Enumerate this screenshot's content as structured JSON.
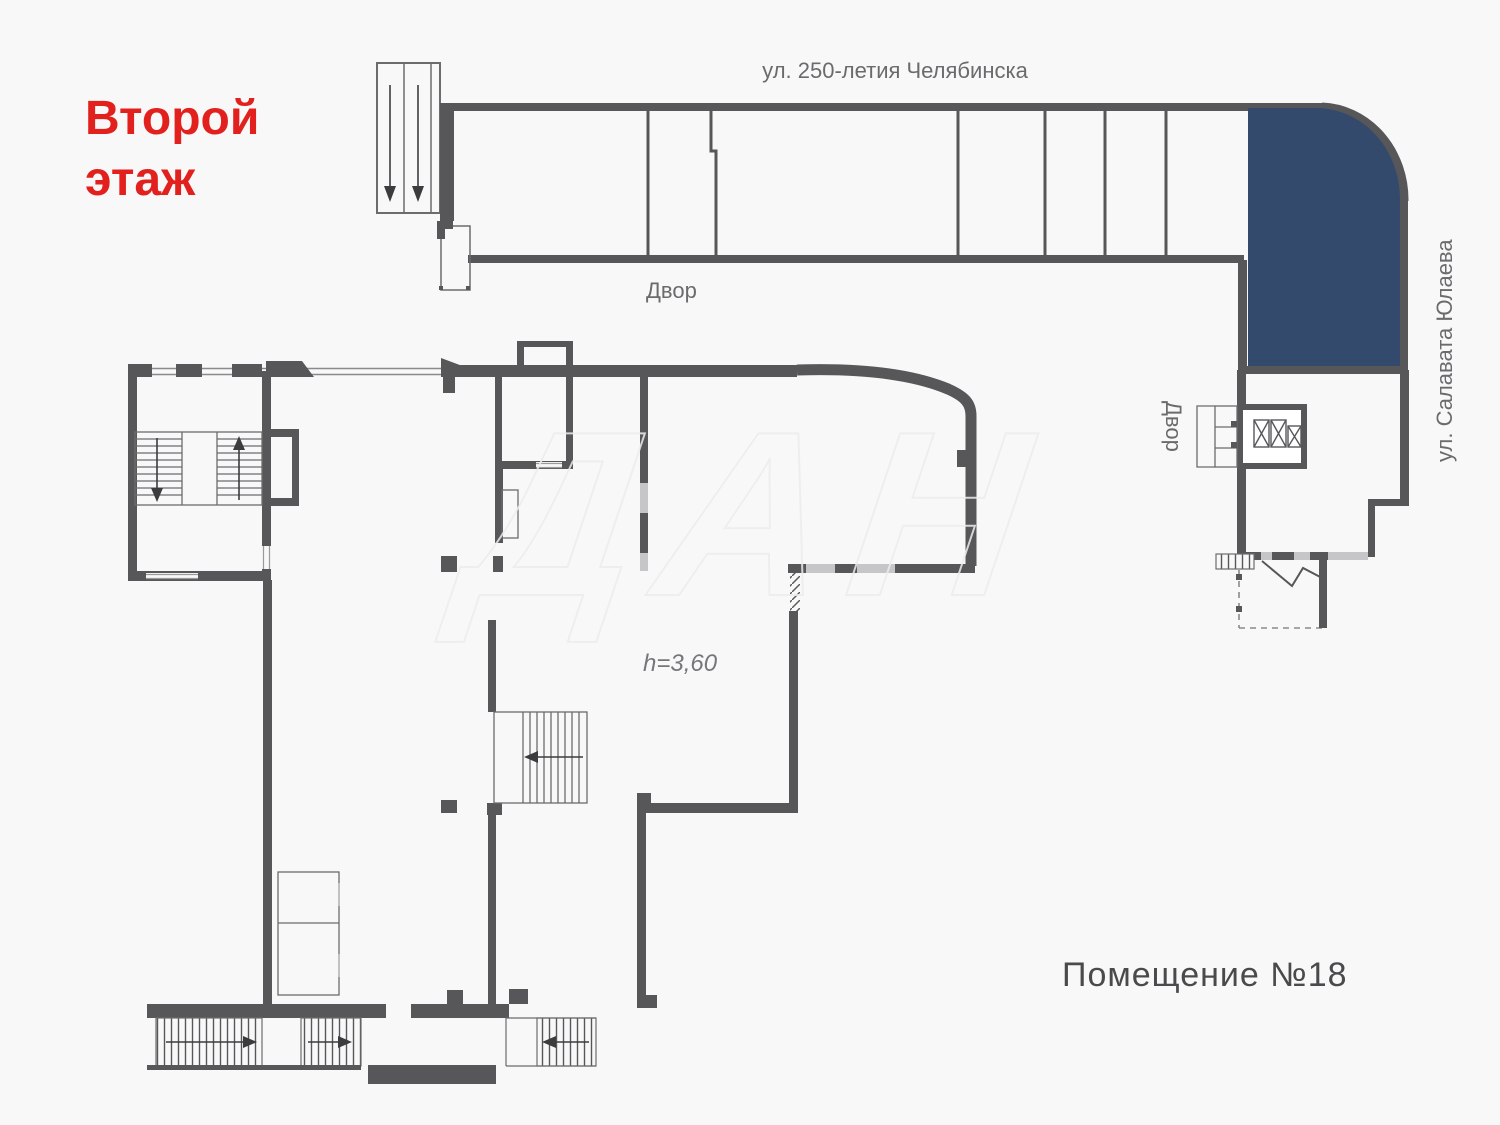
{
  "plan": {
    "floor_title": "Второй\nэтаж",
    "premises_label": "Помещение №18",
    "ceiling_height": "h=3,60"
  },
  "streets": {
    "top": "ул. 250-летия Челябинска",
    "right": "ул. Салавата Юлаева"
  },
  "yards": {
    "top": "Двор",
    "right": "Двор"
  },
  "watermark": "ДАН",
  "colors": {
    "wall": "#57575a",
    "thin_line": "#6c6c6e",
    "window": "#c6c6c8",
    "highlight_unit": "#334a6d",
    "title_red": "#e2211e",
    "label_gray": "#6b6b6d",
    "background": "#f8f8f8"
  }
}
